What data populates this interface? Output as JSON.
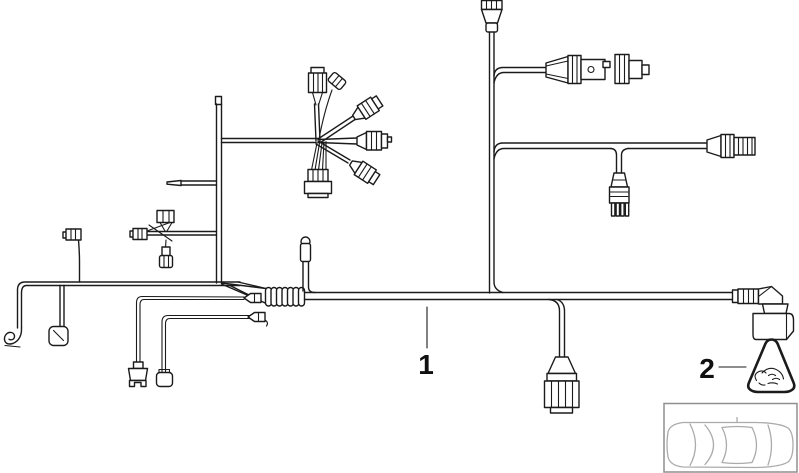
{
  "diagram": {
    "kind": "wiring-harness-parts-diagram",
    "background": "#ffffff"
  },
  "colors": {
    "line": "#1b1b1b",
    "sketch": "#ababab",
    "frame": "#8f8f8f"
  },
  "callouts": {
    "item1": {
      "label": "1"
    },
    "item2": {
      "label": "2"
    }
  },
  "icons": {
    "warning_triangle": "plug-connection-warning-triangle-icon",
    "car_thumbnail": "car-top-view-icon"
  }
}
